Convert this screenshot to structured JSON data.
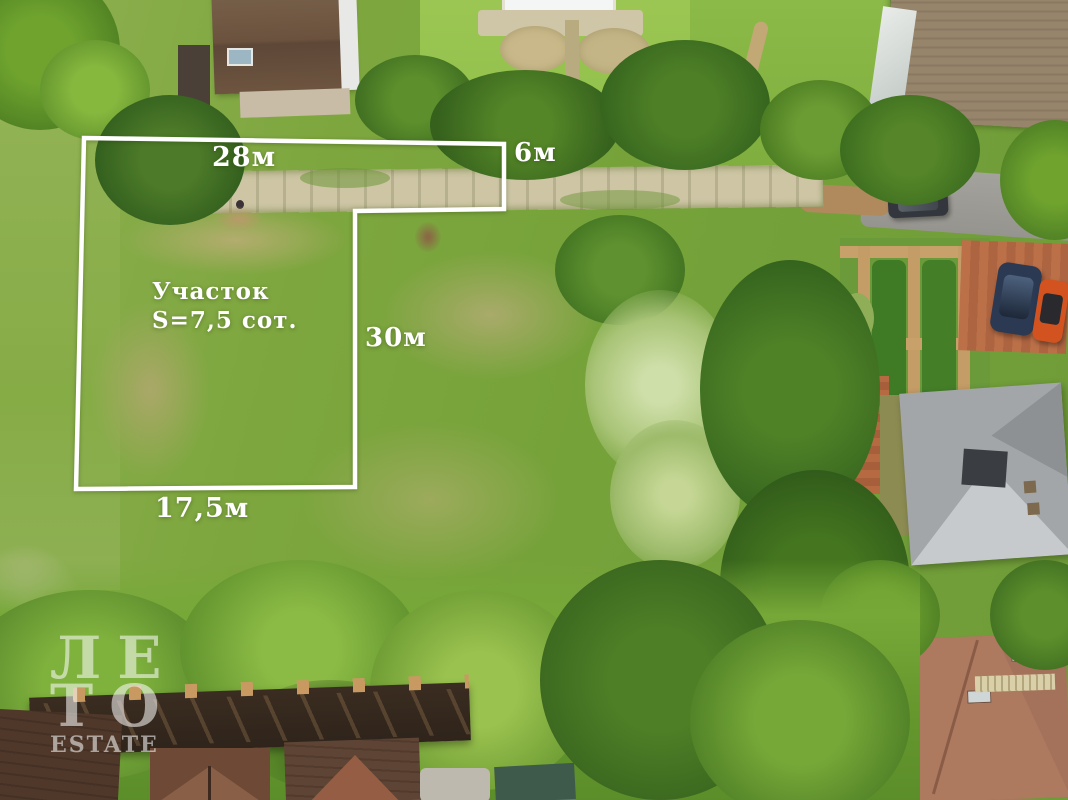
{
  "annotations": {
    "plot_label_line1": "Участок",
    "plot_label_line2": "S=7,5 сот.",
    "top_width": "28м",
    "entrance_width": "6м",
    "side_length": "30м",
    "bottom_width": "17,5м",
    "outline_color": "#ffffff"
  },
  "watermark": {
    "line1": "ЛЕ",
    "line2": "ТО",
    "line3": "ESTATE",
    "color": "#ffffff"
  },
  "palette": {
    "meadow_green": "#7da63e",
    "lawn_light": "#96c053",
    "tree_dark": "#33621d",
    "tree_bright": "#76a838",
    "willow_pale": "#c6d795",
    "dry_grass": "#b3ad6e",
    "path_concrete": "#cdc5a4",
    "road_gray": "#9d9c97",
    "brick_paving": "#b66a42",
    "roof_brown": "#6e543f",
    "roof_gray_brown": "#93815f",
    "roof_gray": "#a3a6a9",
    "roof_red_brown": "#a4725b",
    "car_orange": "#d25320",
    "car_dark_blue": "#2b3a52",
    "car_black": "#33363c"
  }
}
